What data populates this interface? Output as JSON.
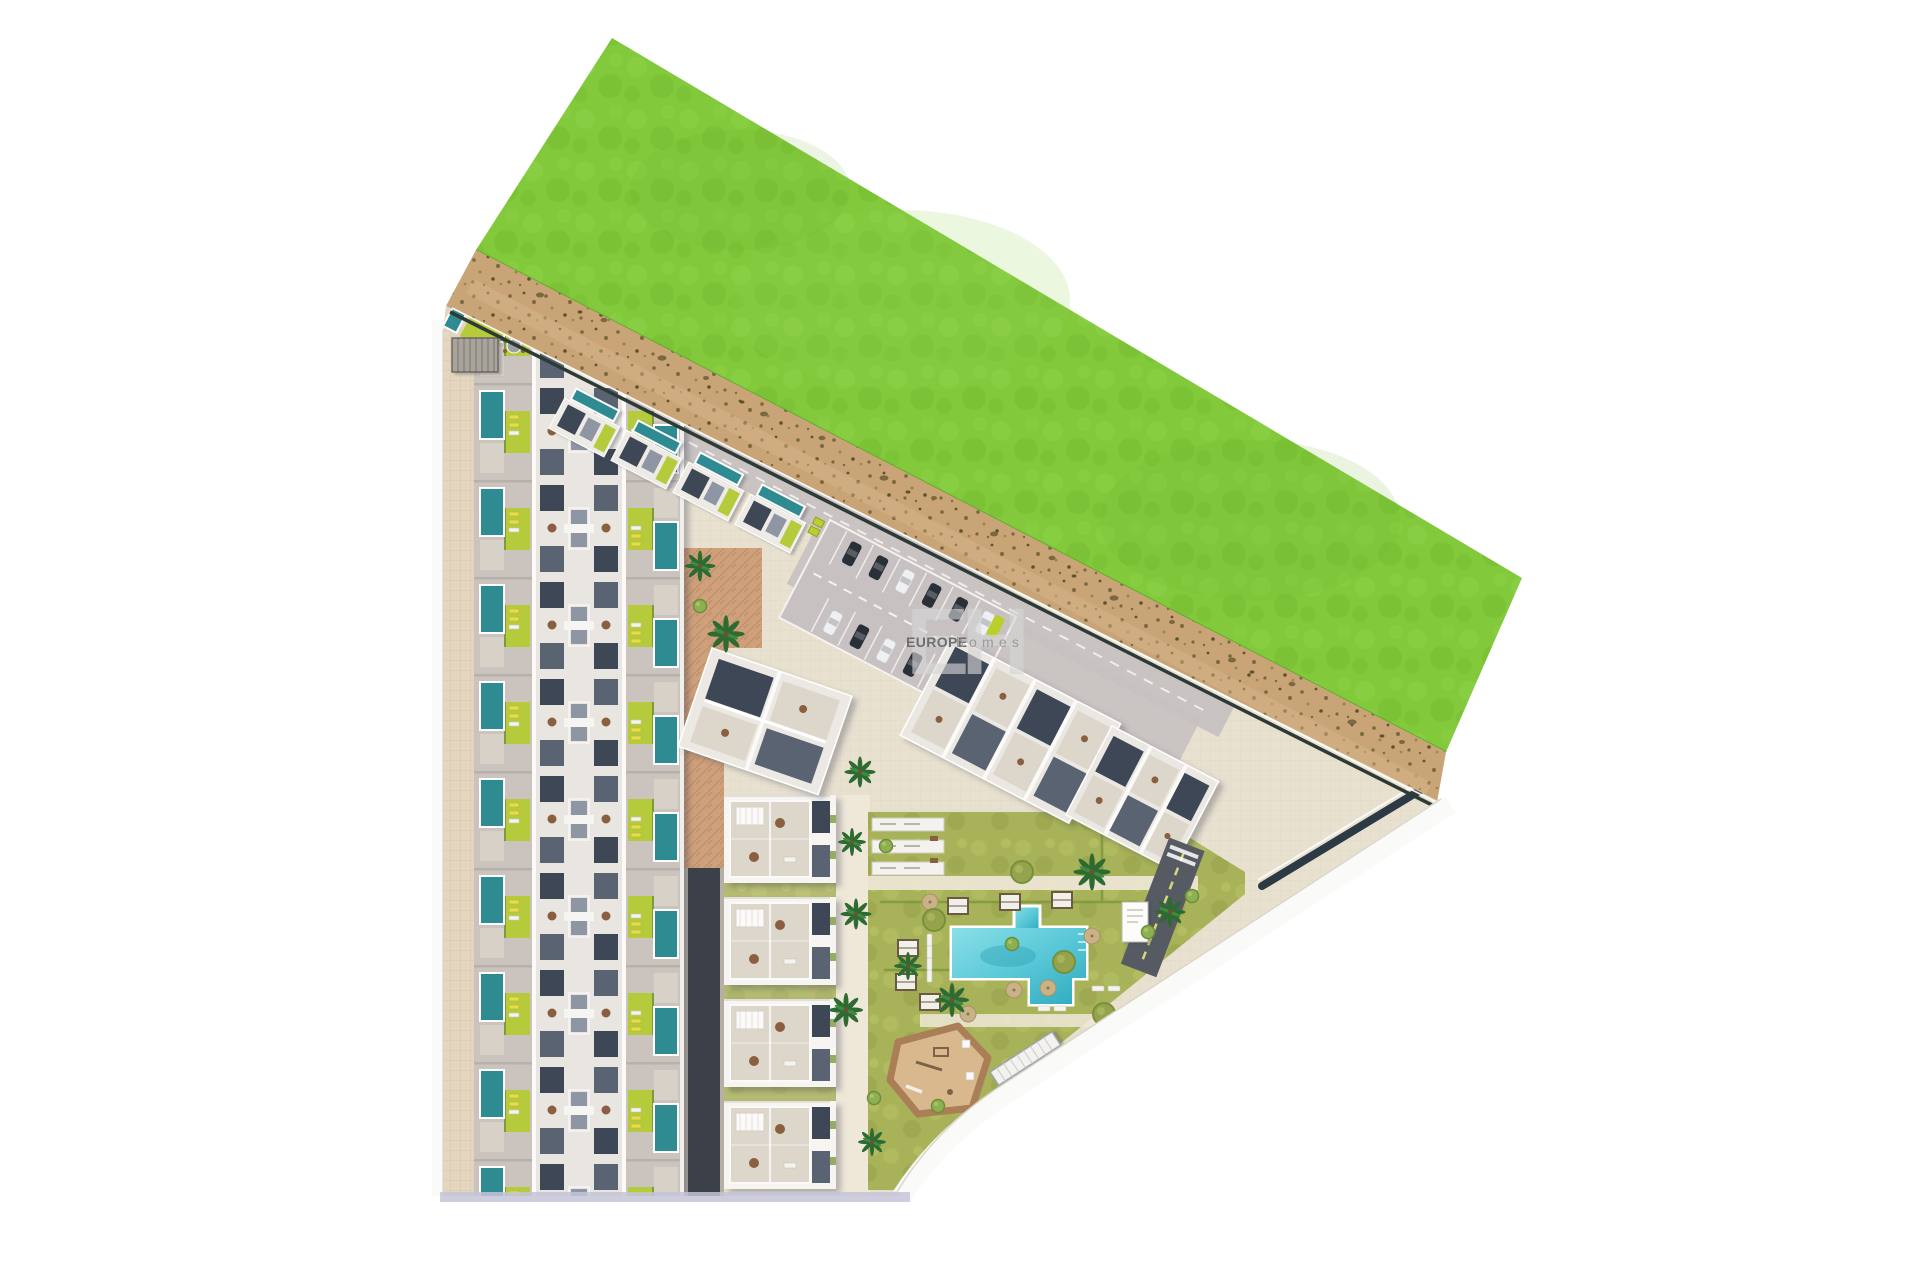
{
  "watermark": {
    "monogram": "EH",
    "brand": "EUROPE",
    "brand_suffix": "homes"
  },
  "scene": {
    "description": "Aerial top-down 3D site plan rendering of a residential development: rows of townhouses with private pools, tilted apartment blocks along a sandy path, communal garden with swimming pool and playground, parking with cars, bordered by a large bright green field on white background",
    "counts": {
      "townhouse_rows": 10,
      "apartment_blocks": 4,
      "tilted_blocks": 3,
      "corner_villas": 4,
      "parked_cars": 13
    }
  },
  "palette": {
    "background": "#ffffff",
    "grass": "#82c93c",
    "grass_light": "#92d44e",
    "grass_dark": "#6fb42c",
    "dirt": "#c9a476",
    "dirt_speckle": "#7a6840",
    "pavement": "#e9e1d0",
    "pavement_light": "#efe8d9",
    "sidewalk": "#e4d6bf",
    "plaza_terracotta": "#cfa07a",
    "road_dark": "#3c4149",
    "lane_gray": "#c7c1c1",
    "building_white": "#f6f5f2",
    "building_light": "#e9e5e0",
    "building_gray": "#cbc4be",
    "terrace": "#ddd6ca",
    "roof_dark": "#3e4754",
    "roof_mid": "#5a6472",
    "roof_gray": "#8d96a2",
    "pool_private": "#2e8b92",
    "pool_main": "#56c6d6",
    "pool_main_deep": "#2fa9bd",
    "lime": "#b5cb3a",
    "lawn": "#a8b259",
    "hedge": "#7d9a40",
    "palm": "#2e6b33",
    "playground_sand": "#d8b88c",
    "playground_border": "#aa7e57",
    "car_dark": "#2a3038",
    "car_white": "#eef0f1",
    "lounger_yellow": "#e5dd4a",
    "furniture_brown": "#8a5f3f",
    "boundary_wall": "#2e3a36",
    "navy_wall": "#2c3a46",
    "perimeter_white": "#fafaf8",
    "shadow_band": "#c4c4d8",
    "watermark_monogram": "#d6d6d6",
    "watermark_brand": "#6f6f6f",
    "watermark_suffix": "#9a9a9a"
  }
}
